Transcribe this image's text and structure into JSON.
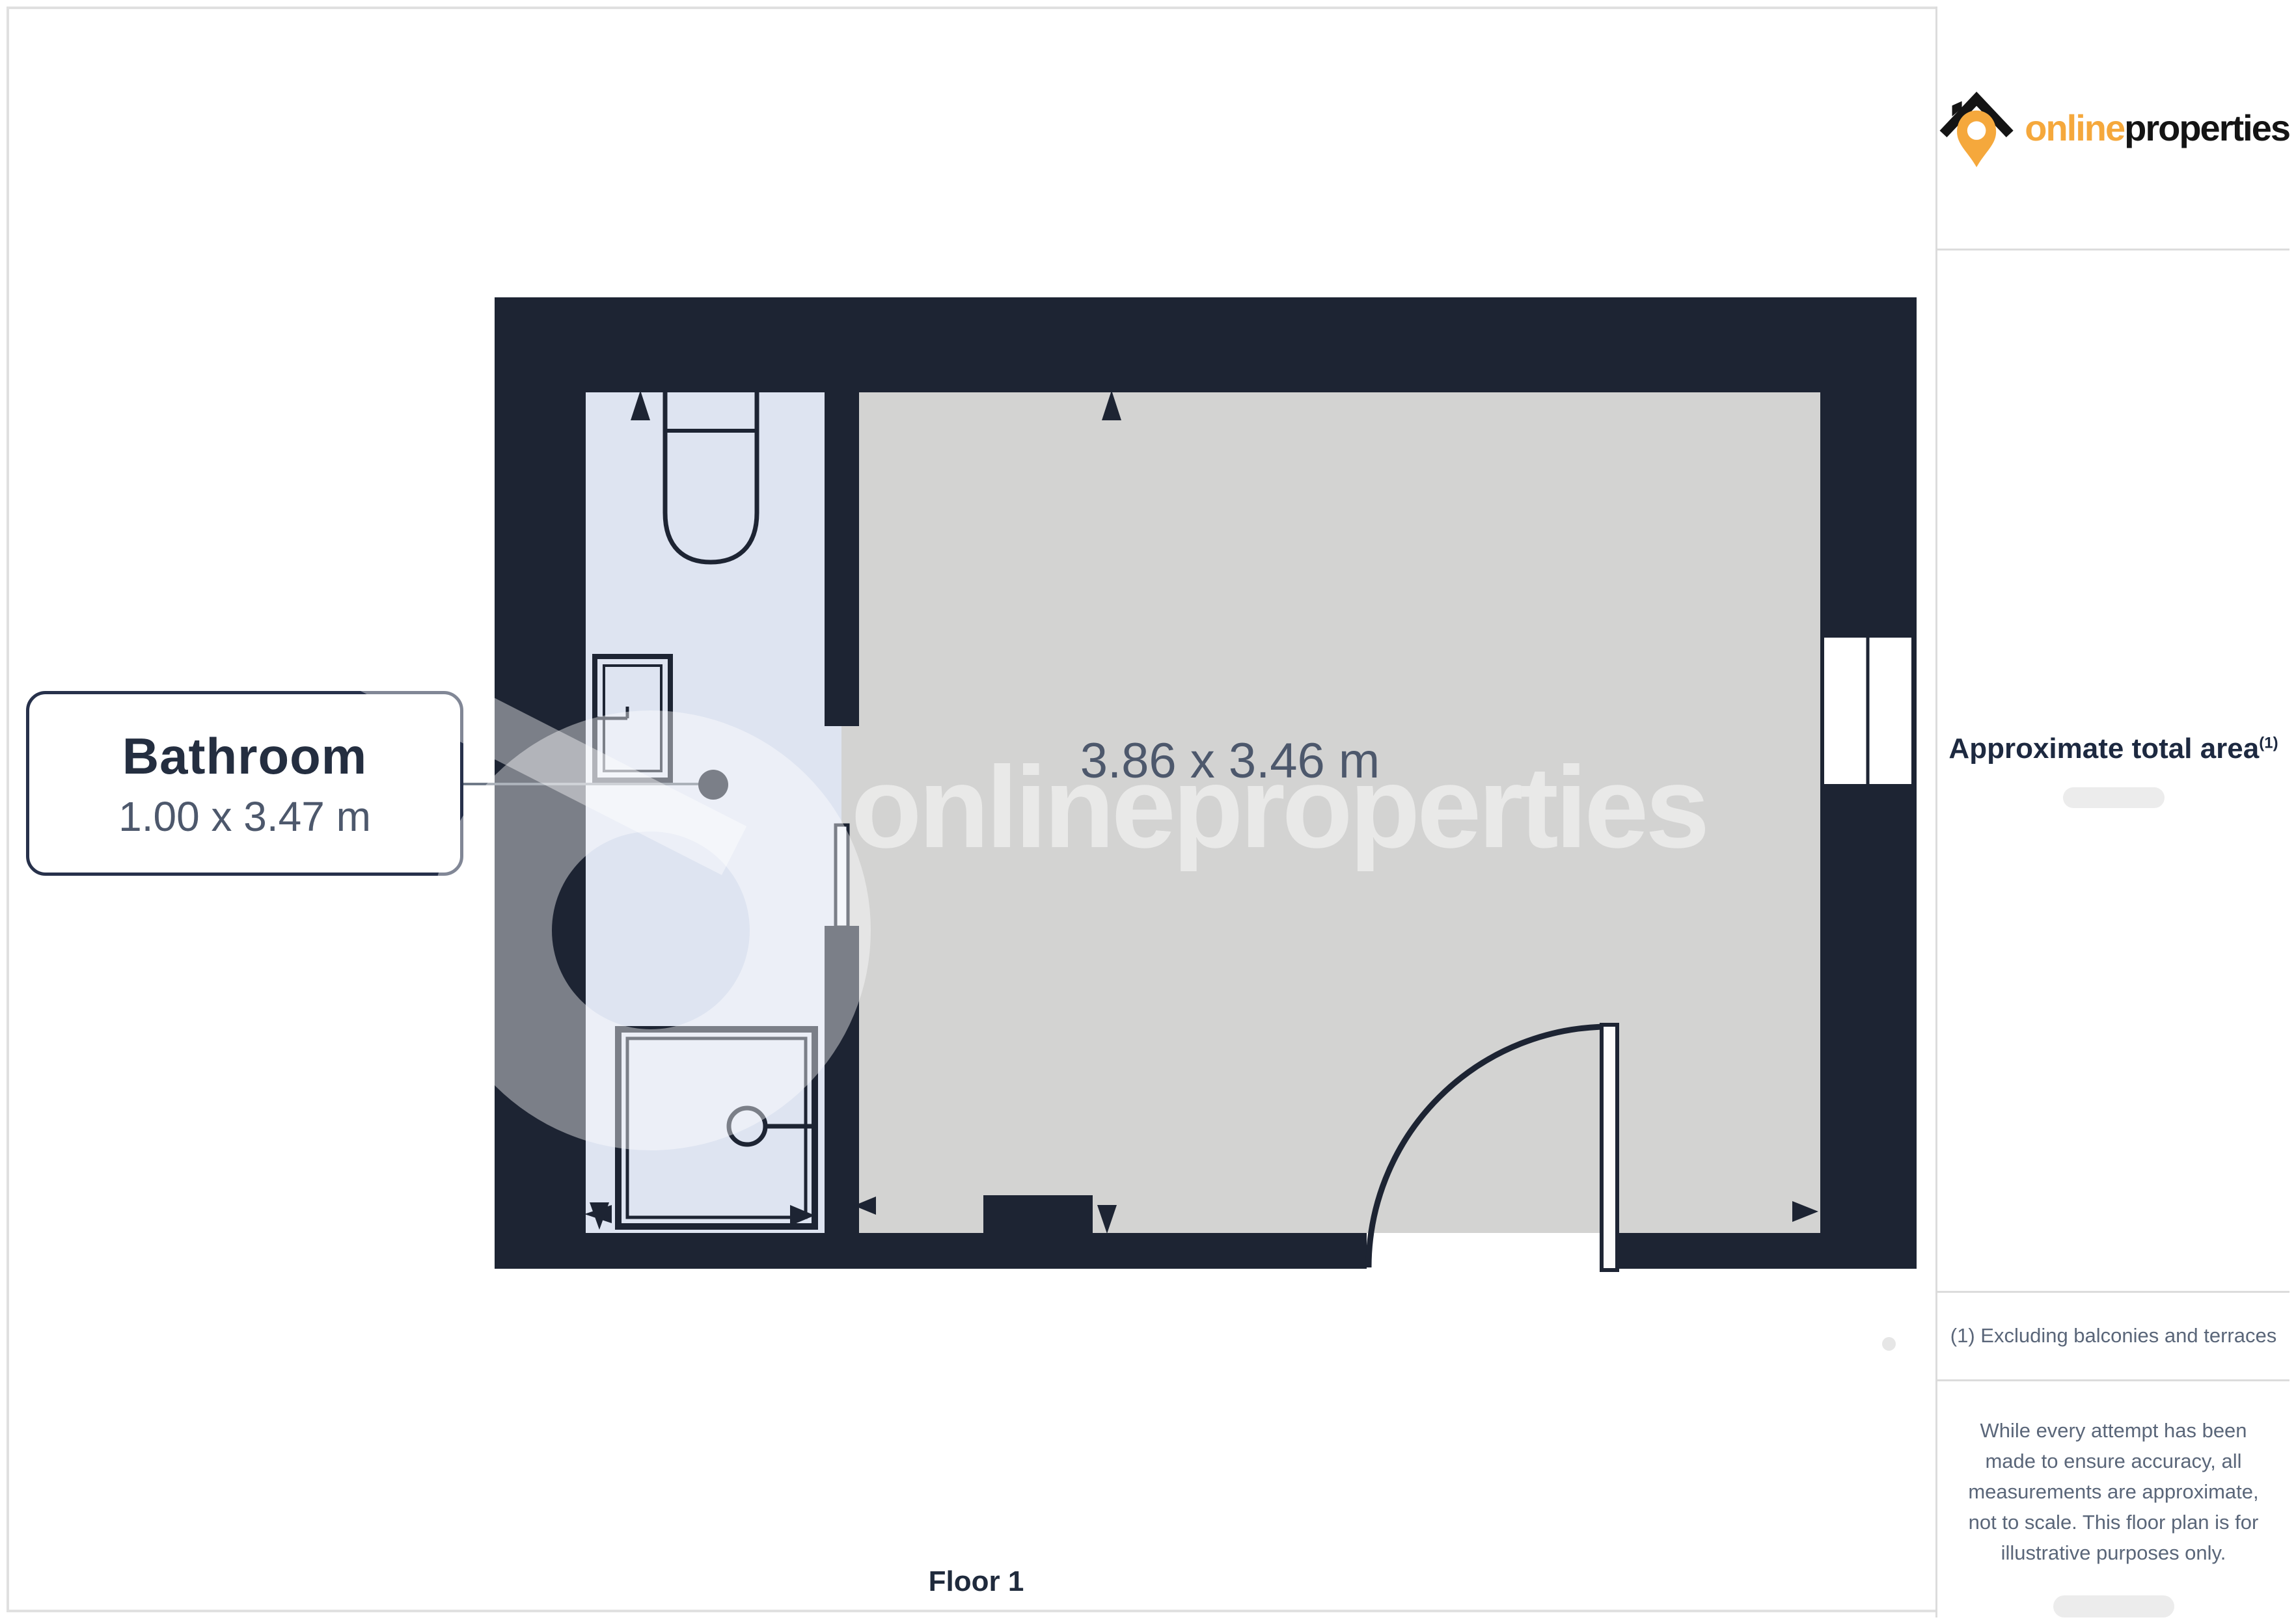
{
  "watermark": {
    "text": "onlineproperties"
  },
  "plan": {
    "room_label": {
      "title": "Bathroom",
      "dims": "1.00 x 3.47 m"
    },
    "main_room_dims": "3.86 x 3.46 m",
    "floor_label": "Floor 1"
  },
  "sidebar": {
    "logo": {
      "brand_first": "online",
      "brand_second": "properties"
    },
    "area": {
      "heading": "Approximate total area",
      "heading_sup": "(1)"
    },
    "footnote": "(1) Excluding balconies and terraces",
    "disclaimer": "While every attempt has been made to ensure accuracy, all measurements are approximate, not to scale. This floor plan is for illustrative purposes only."
  },
  "colors": {
    "wall": "#1d2433",
    "bathroom_floor": "#dee4f1",
    "main_floor": "#d3d3d2",
    "accent_orange": "#f5a83c",
    "label_text": "#242e40",
    "dim_text": "#4d586c",
    "sidebar_text": "#5a6679",
    "divider": "#dcdcdc"
  }
}
